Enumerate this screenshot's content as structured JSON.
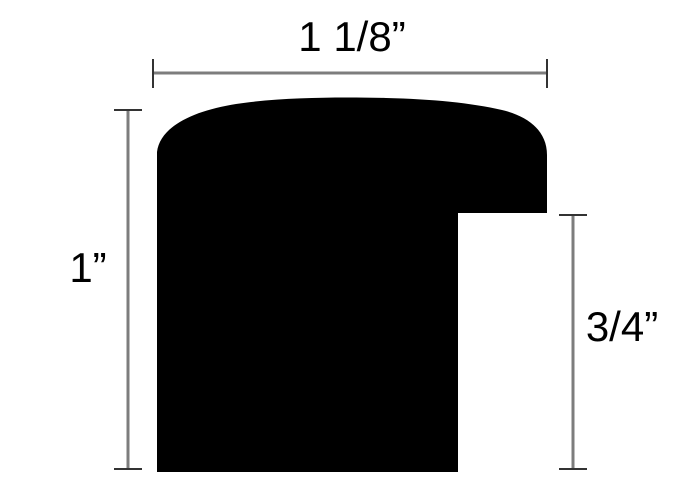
{
  "diagram": {
    "kind": "frame-moulding-profile-cross-section",
    "labels": {
      "top": "1 1/8”",
      "left": "1”",
      "right": "3/4”"
    },
    "dimensions": [
      {
        "edge": "top",
        "value": "1 1/8\""
      },
      {
        "edge": "left",
        "value": "1\""
      },
      {
        "edge": "right",
        "value": "3/4\""
      }
    ]
  },
  "colors": {
    "background": "#ffffff",
    "shape": "#000000",
    "dimension_line": "#7d7d7d",
    "tick": "#333333",
    "text": "#000000"
  }
}
